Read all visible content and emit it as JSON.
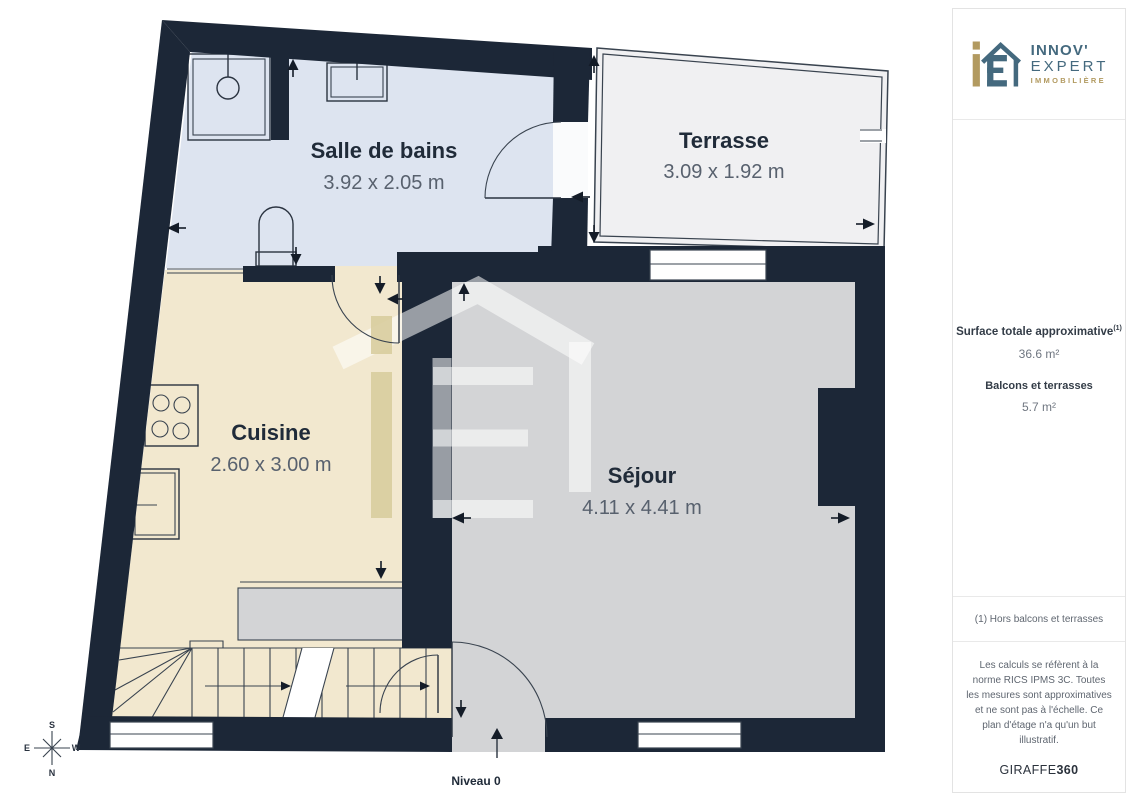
{
  "plan": {
    "level_label": "Niveau 0",
    "rooms": [
      {
        "id": "salle-de-bains",
        "name": "Salle de bains",
        "dimensions": "3.92 x 2.05 m"
      },
      {
        "id": "terrasse",
        "name": "Terrasse",
        "dimensions": "3.09 x 1.92 m"
      },
      {
        "id": "cuisine",
        "name": "Cuisine",
        "dimensions": "2.60 x 3.00 m"
      },
      {
        "id": "sejour",
        "name": "Séjour",
        "dimensions": "4.11 x 4.41 m"
      }
    ],
    "compass": {
      "north": "N",
      "south": "S",
      "east": "E",
      "west": "W"
    }
  },
  "sidebar": {
    "logo": {
      "line1": "INNOV'",
      "line2": "EXPERT",
      "line3": "IMMOBILIÈRE"
    },
    "surface": {
      "total_label": "Surface totale approximative",
      "total_footnote_marker": "(1)",
      "total_value": "36.6 m²",
      "balcony_label": "Balcons et terrasses",
      "balcony_value": "5.7 m²"
    },
    "footnote": "(1) Hors balcons et terrasses",
    "legal": "Les calculs se réfèrent à la norme RICS IPMS 3C. Toutes les mesures sont approximatives et ne sont pas à l'échelle. Ce plan d'étage n'a qu'un but illustratif.",
    "credit": {
      "brand": "GIRAFFE",
      "suffix": "360"
    }
  },
  "colors": {
    "wall": "#1c2737",
    "bathroom_floor": "#dde4f0",
    "kitchen_floor": "#f2e8cf",
    "living_floor": "#d3d4d6",
    "terrace_floor": "#f0f0f2",
    "watermark_gold": "#d9cda0",
    "logo_teal": "#44697e",
    "logo_gold": "#b29a60"
  }
}
